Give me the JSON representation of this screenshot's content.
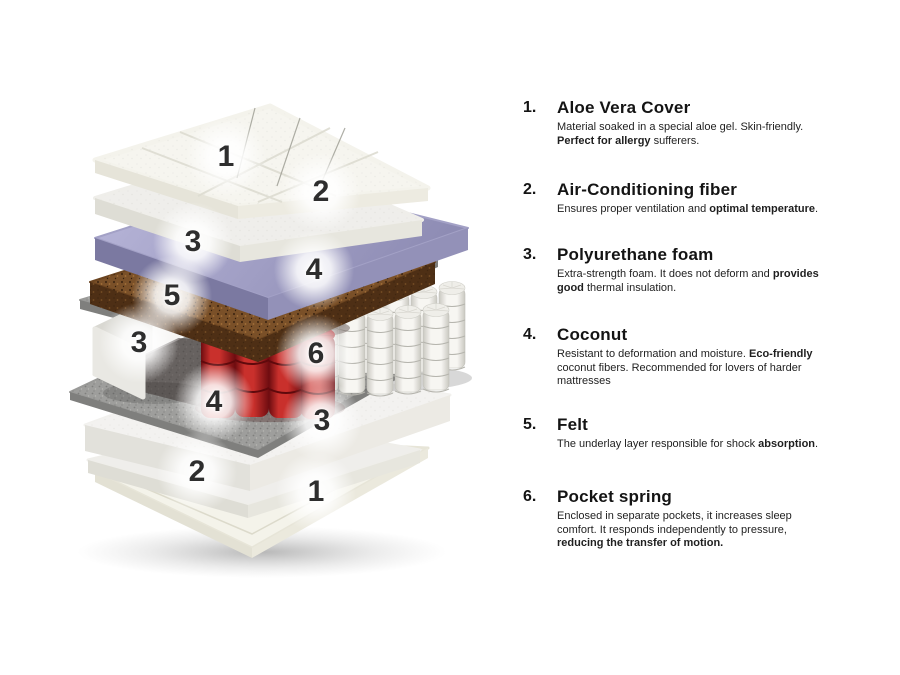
{
  "colors": {
    "background": "#ffffff",
    "textPrimary": "#141414",
    "textBody": "#1f1f1f",
    "labelNumber": "#2e2e2e",
    "coverTop": "#f6f5ef",
    "coverLeft": "#e6e4d9",
    "coverRight": "#edebe1",
    "fiberTop": "#efeeeb",
    "fiberLeft": "#deddd5",
    "fiberRight": "#e7e6de",
    "purpleLight": "#b9b7da",
    "purpleDark": "#8e8cb4",
    "purpleLeft": "#7b79a1",
    "purpleRight": "#9391b8",
    "coconutTop": "#7a5028",
    "coconutFront": "#4e2f15",
    "feltTop": "#9e9e9c",
    "feltFront": "#7f7f7d",
    "springWhiteEdge": "#c9c8c1",
    "springWhiteMid": "#f7f6f2",
    "springRedEdge": "#6e0c10",
    "springRedMid": "#c9302c",
    "foamTop": "#f3f2f0",
    "foamLeft": "#e2e1db",
    "foamRight": "#eceae4",
    "baseTop": "#f4f3ea",
    "baseLeft": "#e3e1d4",
    "baseRight": "#ebe9dd",
    "blockTop": "#f4f3f1",
    "blockEnd": "#d9d8d2",
    "blockFront": "#e9e8e3"
  },
  "diagram": {
    "title": "mattress-layers-exploded-view",
    "labels": [
      {
        "n": "1",
        "x": 226,
        "y": 157
      },
      {
        "n": "2",
        "x": 321,
        "y": 192
      },
      {
        "n": "3",
        "x": 193,
        "y": 242
      },
      {
        "n": "4",
        "x": 314,
        "y": 270
      },
      {
        "n": "5",
        "x": 172,
        "y": 296
      },
      {
        "n": "3",
        "x": 139,
        "y": 343
      },
      {
        "n": "6",
        "x": 316,
        "y": 354
      },
      {
        "n": "4",
        "x": 214,
        "y": 402
      },
      {
        "n": "3",
        "x": 322,
        "y": 421
      },
      {
        "n": "2",
        "x": 197,
        "y": 472
      },
      {
        "n": "1",
        "x": 316,
        "y": 492
      }
    ]
  },
  "legend": {
    "items": [
      {
        "number": "1.",
        "title": "Aloe Vera Cover",
        "top": 98,
        "body": [
          {
            "t": "Material soaked in a special aloe gel. Skin-friendly. ",
            "b": false
          },
          {
            "t": "Perfect for allergy",
            "b": true
          },
          {
            "t": " sufferers.",
            "b": false
          }
        ]
      },
      {
        "number": "2.",
        "title": "Air-Conditioning fiber",
        "top": 180,
        "body": [
          {
            "t": "Ensures proper ventilation and ",
            "b": false
          },
          {
            "t": "optimal temperature",
            "b": true
          },
          {
            "t": ".",
            "b": false
          }
        ]
      },
      {
        "number": "3.",
        "title": "Polyurethane foam",
        "top": 245,
        "body": [
          {
            "t": "Extra-strength foam. It does not deform and ",
            "b": false
          },
          {
            "t": "provides good",
            "b": true
          },
          {
            "t": " thermal insulation.",
            "b": false
          }
        ]
      },
      {
        "number": "4.",
        "title": "Coconut",
        "top": 325,
        "body": [
          {
            "t": "Resistant to deformation and moisture. ",
            "b": false
          },
          {
            "t": "Eco-friendly",
            "b": true
          },
          {
            "t": " coconut fibers. Recommended for lovers of harder mattresses",
            "b": false
          }
        ]
      },
      {
        "number": "5.",
        "title": "Felt",
        "top": 415,
        "body": [
          {
            "t": "The underlay layer responsible for shock ",
            "b": false
          },
          {
            "t": "absorption",
            "b": true
          },
          {
            "t": ".",
            "b": false
          }
        ]
      },
      {
        "number": "6.",
        "title": "Pocket spring",
        "top": 487,
        "body": [
          {
            "t": "Enclosed in separate pockets, it increases sleep comfort. It responds independently to pressure, ",
            "b": false
          },
          {
            "t": "reducing the transfer of motion.",
            "b": true
          }
        ]
      }
    ]
  }
}
